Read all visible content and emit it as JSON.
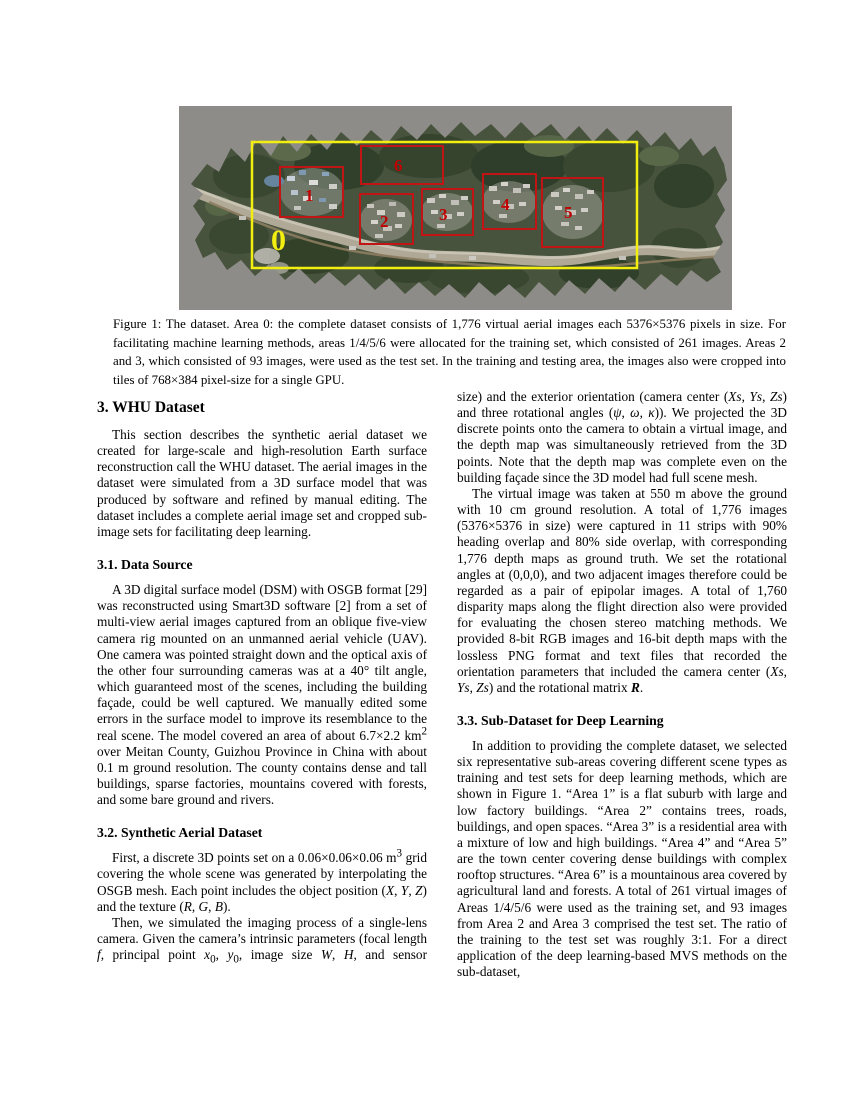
{
  "figure": {
    "bg_color": "#8e8c89",
    "terrain_color": "#47533c",
    "complete_box_color": "#f2ee10",
    "sub_box_color": "#c11414",
    "sub_label_color": "#c00000",
    "complete_label_color": "#f2ee10",
    "area_labels": {
      "a0": "0",
      "a1": "1",
      "a2": "2",
      "a3": "3",
      "a4": "4",
      "a5": "5",
      "a6": "6"
    },
    "caption": "Figure 1: The dataset. Area 0: the complete dataset consists of 1,776 virtual aerial images each 5376×5376 pixels in size. For facilitating machine learning methods, areas 1/4/5/6 were allocated for the training set, which consisted of 261 images. Areas 2 and 3, which consisted of 93 images, were used as the test set. In the training and testing area, the images also were cropped into tiles of 768×384 pixel-size for a single GPU."
  },
  "left_column": {
    "section3_heading": "3. WHU Dataset",
    "p_intro": "This section describes the synthetic aerial dataset we created for large-scale and high-resolution Earth surface reconstruction call the WHU dataset. The aerial images in the dataset were simulated from a 3D surface model that was produced by software and refined by manual editing. The dataset includes a complete aerial image set and cropped sub-image sets for facilitating deep learning.",
    "section31_heading": "3.1. Data Source",
    "p_datasource_html": "A 3D digital surface model (DSM) with OSGB format [29] was reconstructed using Smart3D software [2] from a set of multi-view aerial images captured from an oblique five-view camera rig mounted on an unmanned aerial vehicle (UAV). One camera was pointed straight down and the optical axis of the other four surrounding cameras was at a 40° tilt angle, which guaranteed most of the scenes, including the building façade, could be well captured. We manually edited some errors in the surface model to improve its resemblance to the real scene. The model covered an area of about 6.7×2.2 km<sup>2</sup> over Meitan County, Guizhou Province in China with about 0.1 m ground resolution. The county contains dense and tall buildings, sparse factories, mountains covered with forests, and some bare ground and rivers.",
    "section32_heading": "3.2. Synthetic Aerial Dataset",
    "p_points_html": "First, a discrete 3D points set on a 0.06×0.06×0.06 m<sup>3</sup> grid covering the whole scene was generated by interpolating the OSGB mesh. Each point includes the object position (<i>X</i>, <i>Y</i>, <i>Z</i>) and the texture (<i>R</i>, <i>G</i>, <i>B</i>).",
    "p_camera_html": "Then, we simulated the imaging process of a single-lens camera. Given the camera’s intrinsic parameters (focal length <i>f</i>, principal point <i>x</i><sub>0</sub>, <i>y</i><sub>0</sub>, image size <i>W</i>, <i>H</i>, and sensor"
  },
  "right_column": {
    "p_exterior_html": "size) and the exterior orientation (camera center (<i>Xs</i>, <i>Ys</i>, <i>Zs</i>) and three rotational angles (<i>ψ</i>, <i>ω</i>, <i>κ</i>)). We projected the 3D discrete points onto the camera to obtain a virtual image, and the depth map was simultaneously retrieved from the 3D points. Note that the depth map was complete even on the building façade since the 3D model had full scene mesh.",
    "p_virtual_html": "The virtual image was taken at 550 m above the ground with 10 cm ground resolution. A total of 1,776 images (5376×5376 in size) were captured in 11 strips with 90% heading overlap and 80% side overlap, with corresponding 1,776 depth maps as ground truth. We set the rotational angles at (0,0,0), and two adjacent images therefore could be regarded as a pair of epipolar images. A total of 1,760 disparity maps along the flight direction also were provided for evaluating the chosen stereo matching methods. We provided 8-bit RGB images and 16-bit depth maps with the lossless PNG format and text files that recorded the orientation parameters that included the camera center (<i>Xs</i>, <i>Ys</i>, <i>Zs</i>) and the rotational matrix <b><i>R</i></b>.",
    "section33_heading": "3.3. Sub-Dataset for Deep Learning",
    "p_subdataset": "In addition to providing the complete dataset, we selected six representative sub-areas covering different scene types as training and test sets for deep learning methods, which are shown in Figure 1. “Area 1” is a flat suburb with large and low factory buildings. “Area 2” contains trees, roads, buildings, and open spaces. “Area 3” is a residential area with a mixture of low and high buildings. “Area 4” and “Area 5” are the town center covering dense buildings with complex rooftop structures. “Area 6” is a mountainous area covered by agricultural land and forests. A total of 261 virtual images of Areas 1/4/5/6 were used as the training set, and 93 images from Area 2 and Area 3 comprised the test set. The ratio of the training to the test set was roughly 3:1. For a direct application of the deep learning-based MVS methods on the sub-dataset,"
  }
}
